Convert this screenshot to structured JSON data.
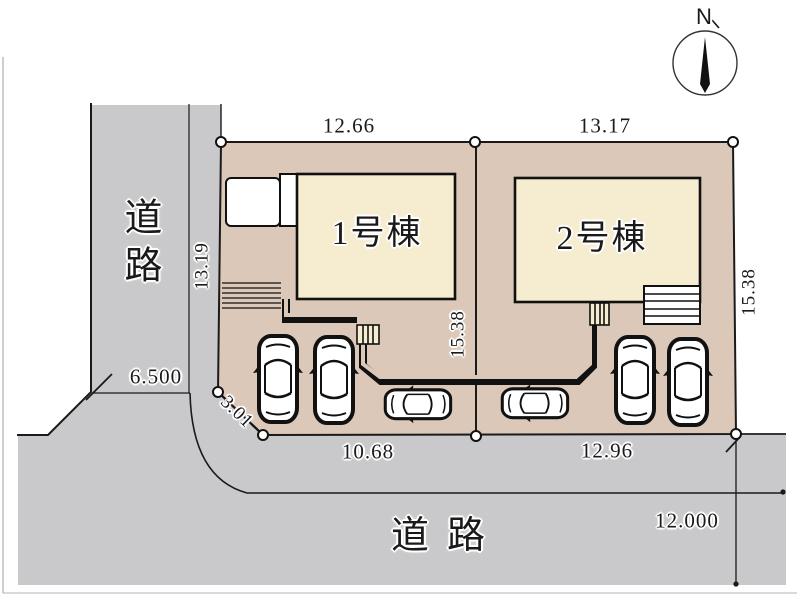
{
  "figure": "housing-site-plan",
  "compass": {
    "north_label": "N"
  },
  "roads": {
    "west": {
      "name": "道路",
      "width_dimension": "6.500"
    },
    "south": {
      "name": "道路",
      "width_dimension": "12.000"
    }
  },
  "boundary": {
    "corner_cut_length": "3.01"
  },
  "lots": {
    "lot1": {
      "building_label": "1号棟",
      "frontage_north": "12.66",
      "side_west": "13.19",
      "side_east": "15.38",
      "frontage_south": "10.68"
    },
    "lot2": {
      "building_label": "2号棟",
      "frontage_north": "13.17",
      "side_east": "15.38",
      "frontage_south": "12.96"
    }
  },
  "colors": {
    "road_fill": "#c9c9cc",
    "lot_fill": "#dcc8b8",
    "building_fill": "#f6ecd0",
    "line": "#1a1a1a"
  }
}
